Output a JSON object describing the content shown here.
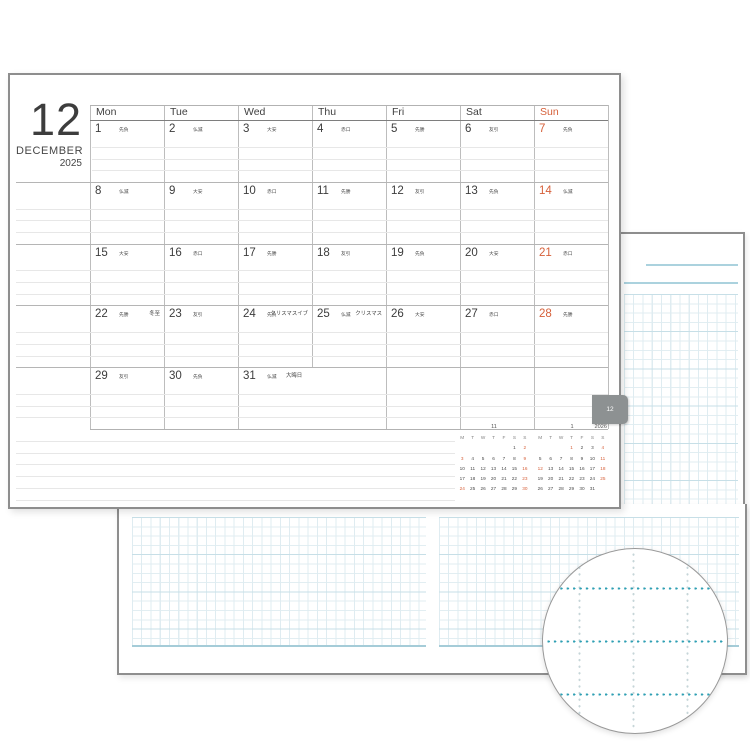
{
  "calendar": {
    "month_number": "12",
    "month_name": "DECEMBER",
    "year": "2025",
    "tab_label": "12",
    "weekday_headers": [
      "Mon",
      "Tue",
      "Wed",
      "Thu",
      "Fri",
      "Sat",
      "Sun"
    ],
    "days": [
      {
        "date": "1",
        "rokuyo": "先負"
      },
      {
        "date": "2",
        "rokuyo": "仏滅"
      },
      {
        "date": "3",
        "rokuyo": "大安"
      },
      {
        "date": "4",
        "rokuyo": "赤口"
      },
      {
        "date": "5",
        "rokuyo": "先勝"
      },
      {
        "date": "6",
        "rokuyo": "友引"
      },
      {
        "date": "7",
        "rokuyo": "先負"
      },
      {
        "date": "8",
        "rokuyo": "仏滅"
      },
      {
        "date": "9",
        "rokuyo": "大安"
      },
      {
        "date": "10",
        "rokuyo": "赤口"
      },
      {
        "date": "11",
        "rokuyo": "先勝"
      },
      {
        "date": "12",
        "rokuyo": "友引"
      },
      {
        "date": "13",
        "rokuyo": "先負"
      },
      {
        "date": "14",
        "rokuyo": "仏滅"
      },
      {
        "date": "15",
        "rokuyo": "大安"
      },
      {
        "date": "16",
        "rokuyo": "赤口"
      },
      {
        "date": "17",
        "rokuyo": "先勝"
      },
      {
        "date": "18",
        "rokuyo": "友引"
      },
      {
        "date": "19",
        "rokuyo": "先負"
      },
      {
        "date": "20",
        "rokuyo": "大安"
      },
      {
        "date": "21",
        "rokuyo": "赤口"
      },
      {
        "date": "22",
        "rokuyo": "先勝",
        "note": "冬至"
      },
      {
        "date": "23",
        "rokuyo": "友引"
      },
      {
        "date": "24",
        "rokuyo": "先負",
        "note": "クリスマスイブ"
      },
      {
        "date": "25",
        "rokuyo": "仏滅",
        "note": "クリスマス"
      },
      {
        "date": "26",
        "rokuyo": "大安"
      },
      {
        "date": "27",
        "rokuyo": "赤口"
      },
      {
        "date": "28",
        "rokuyo": "先勝"
      },
      {
        "date": "29",
        "rokuyo": "友引"
      },
      {
        "date": "30",
        "rokuyo": "先負"
      },
      {
        "date": "31",
        "rokuyo": "仏滅",
        "note": "大晦日",
        "wide": true
      }
    ]
  },
  "mini_calendars": [
    {
      "title": "11",
      "year": "",
      "headers": [
        "M",
        "T",
        "W",
        "T",
        "F",
        "S",
        "S"
      ],
      "cells": [
        "",
        "",
        "",
        "",
        "",
        "1",
        "2",
        "3",
        "4",
        "5",
        "6",
        "7",
        "8",
        "9",
        "10",
        "11",
        "12",
        "13",
        "14",
        "15",
        "16",
        "17",
        "18",
        "19",
        "20",
        "21",
        "22",
        "23",
        "24",
        "25",
        "26",
        "27",
        "28",
        "29",
        "30"
      ],
      "highlighted": [
        "2",
        "3",
        "9",
        "16",
        "23",
        "24",
        "30"
      ]
    },
    {
      "title": "1",
      "year": "2026",
      "headers": [
        "M",
        "T",
        "W",
        "T",
        "F",
        "S",
        "S"
      ],
      "cells": [
        "",
        "",
        "",
        "1",
        "2",
        "3",
        "4",
        "5",
        "6",
        "7",
        "8",
        "9",
        "10",
        "11",
        "12",
        "13",
        "14",
        "15",
        "16",
        "17",
        "18",
        "19",
        "20",
        "21",
        "22",
        "23",
        "24",
        "25",
        "26",
        "27",
        "28",
        "29",
        "30",
        "31",
        ""
      ],
      "highlighted": [
        "1",
        "4",
        "11",
        "12",
        "18",
        "25"
      ]
    }
  ],
  "colors": {
    "accent_orange": "#d6603a",
    "tab_gray": "#8d9192",
    "page_border": "#8e8e8e",
    "grid_blue_light": "#e2eef2",
    "grid_blue_strong": "#c7dfe7",
    "rule_blue": "#abd2de",
    "dot_teal": "#2e9fb3",
    "dot_gray": "#c6d5d8"
  }
}
